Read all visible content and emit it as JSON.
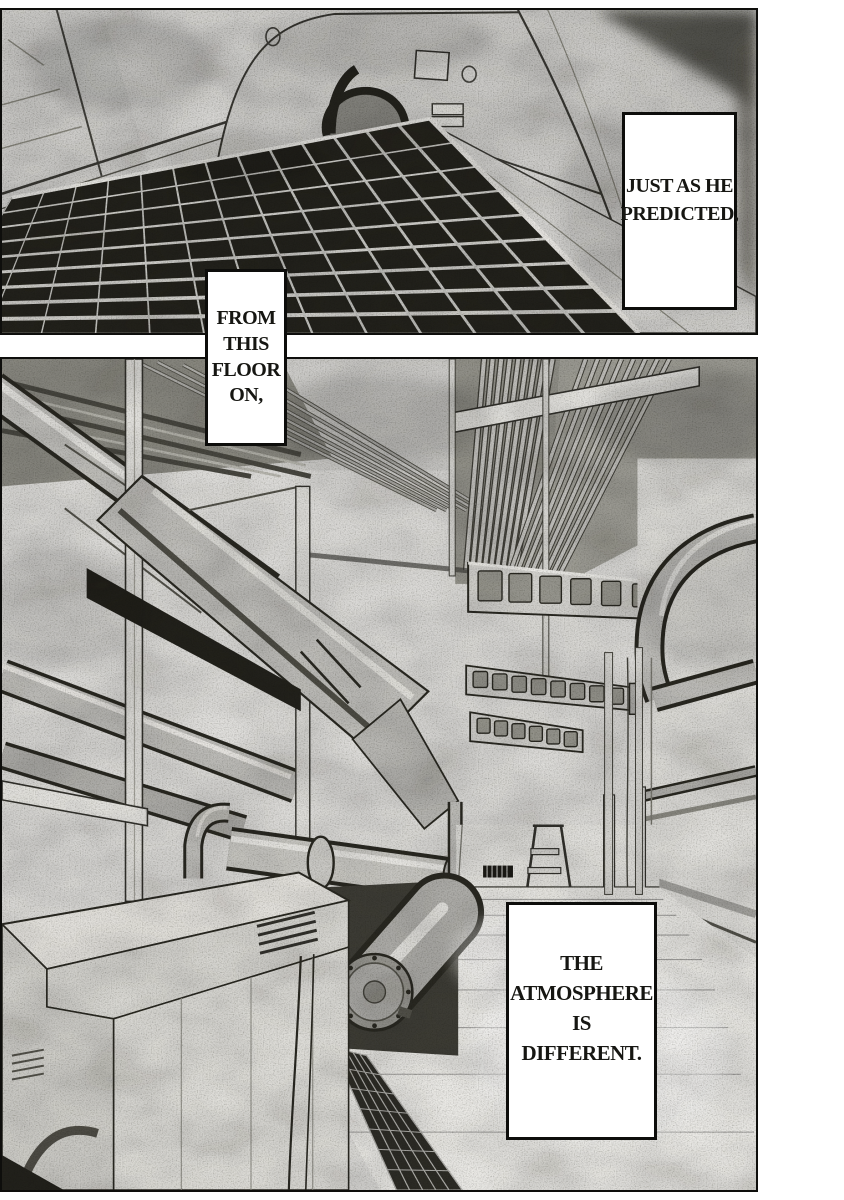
{
  "captions": {
    "predicted": {
      "lines": [
        "JUST AS HE",
        "PREDICTED,"
      ]
    },
    "floor": {
      "lines": [
        "FROM",
        "THIS",
        "FLOOR",
        "ON,"
      ]
    },
    "atmosphere": {
      "lines": [
        "THE",
        "ATMOSPHERE",
        "IS",
        "DIFFERENT."
      ]
    }
  },
  "colors": {
    "paper": "#ffffff",
    "ink": "#0d0d0b",
    "panel_background": "#e0dfdc",
    "caption_background": "#ffffff",
    "grate_dark": "#23221c"
  }
}
